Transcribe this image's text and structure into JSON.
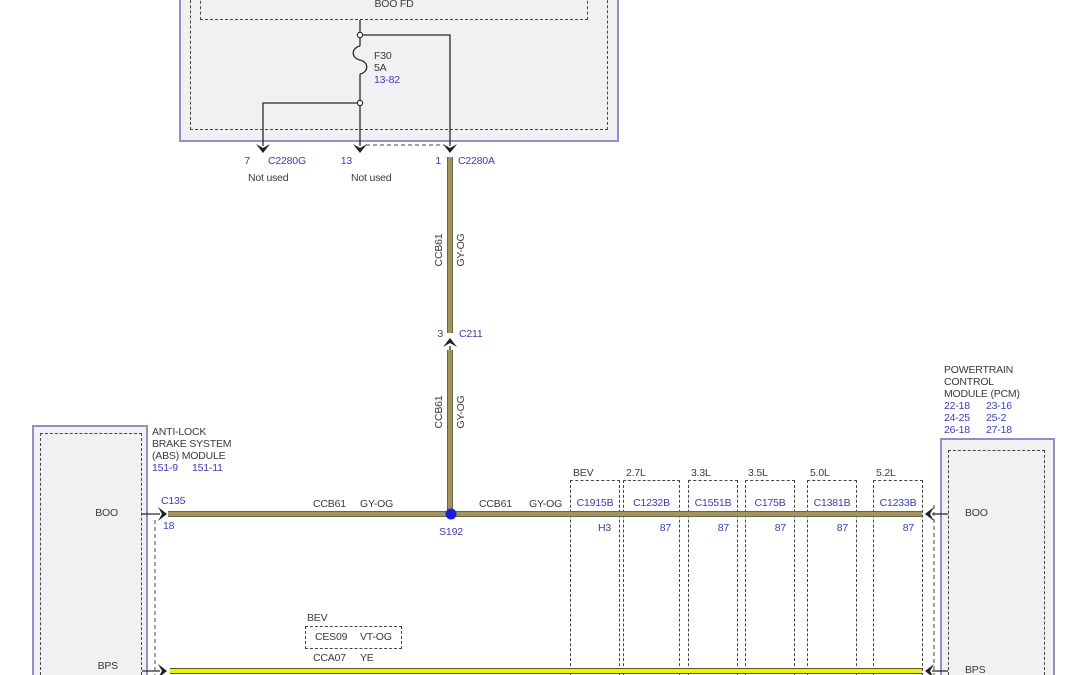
{
  "fusebox": {
    "label": "BOO FD",
    "fuse": {
      "name": "F30",
      "rating": "5A",
      "ref": "13-82"
    },
    "pins": [
      {
        "pin": "7",
        "connector": "C2280G",
        "note": "Not used"
      },
      {
        "pin": "13",
        "connector": "",
        "note": "Not used"
      },
      {
        "pin": "1",
        "connector": "C2280A",
        "note": ""
      }
    ]
  },
  "wires": {
    "boo": {
      "circuit": "CCB61",
      "color": "GY-OG"
    },
    "bps": {
      "circuit": "CCA07",
      "color": "YE"
    },
    "bps_bev": {
      "label": "BEV",
      "circuit": "CES09",
      "color": "VT-OG"
    }
  },
  "connectors": {
    "c211": {
      "pin": "3",
      "name": "C211"
    },
    "splice": "S192",
    "c135": {
      "name": "C135",
      "pin": "18"
    }
  },
  "abs_module": {
    "title": [
      "ANTI-LOCK",
      "BRAKE SYSTEM",
      "(ABS) MODULE"
    ],
    "refs": [
      "151-9",
      "151-11"
    ],
    "pins": {
      "boo": "BOO",
      "bps": "BPS"
    }
  },
  "pcm": {
    "title": [
      "POWERTRAIN",
      "CONTROL",
      "MODULE (PCM)"
    ],
    "refs": [
      [
        "22-18",
        "23-16"
      ],
      [
        "24-25",
        "25-2"
      ],
      [
        "26-18",
        "27-18"
      ]
    ],
    "pins": {
      "boo": "BOO",
      "bps": "BPS"
    }
  },
  "engine_variants": [
    {
      "label": "BEV",
      "connector": "C1915B",
      "pin": "H3"
    },
    {
      "label": "2.7L",
      "connector": "C1232B",
      "pin": "87"
    },
    {
      "label": "3.3L",
      "connector": "C1551B",
      "pin": "87"
    },
    {
      "label": "3.5L",
      "connector": "C175B",
      "pin": "87"
    },
    {
      "label": "5.0L",
      "connector": "C1381B",
      "pin": "87"
    },
    {
      "label": "5.2L",
      "connector": "C1233B",
      "pin": "87"
    }
  ]
}
